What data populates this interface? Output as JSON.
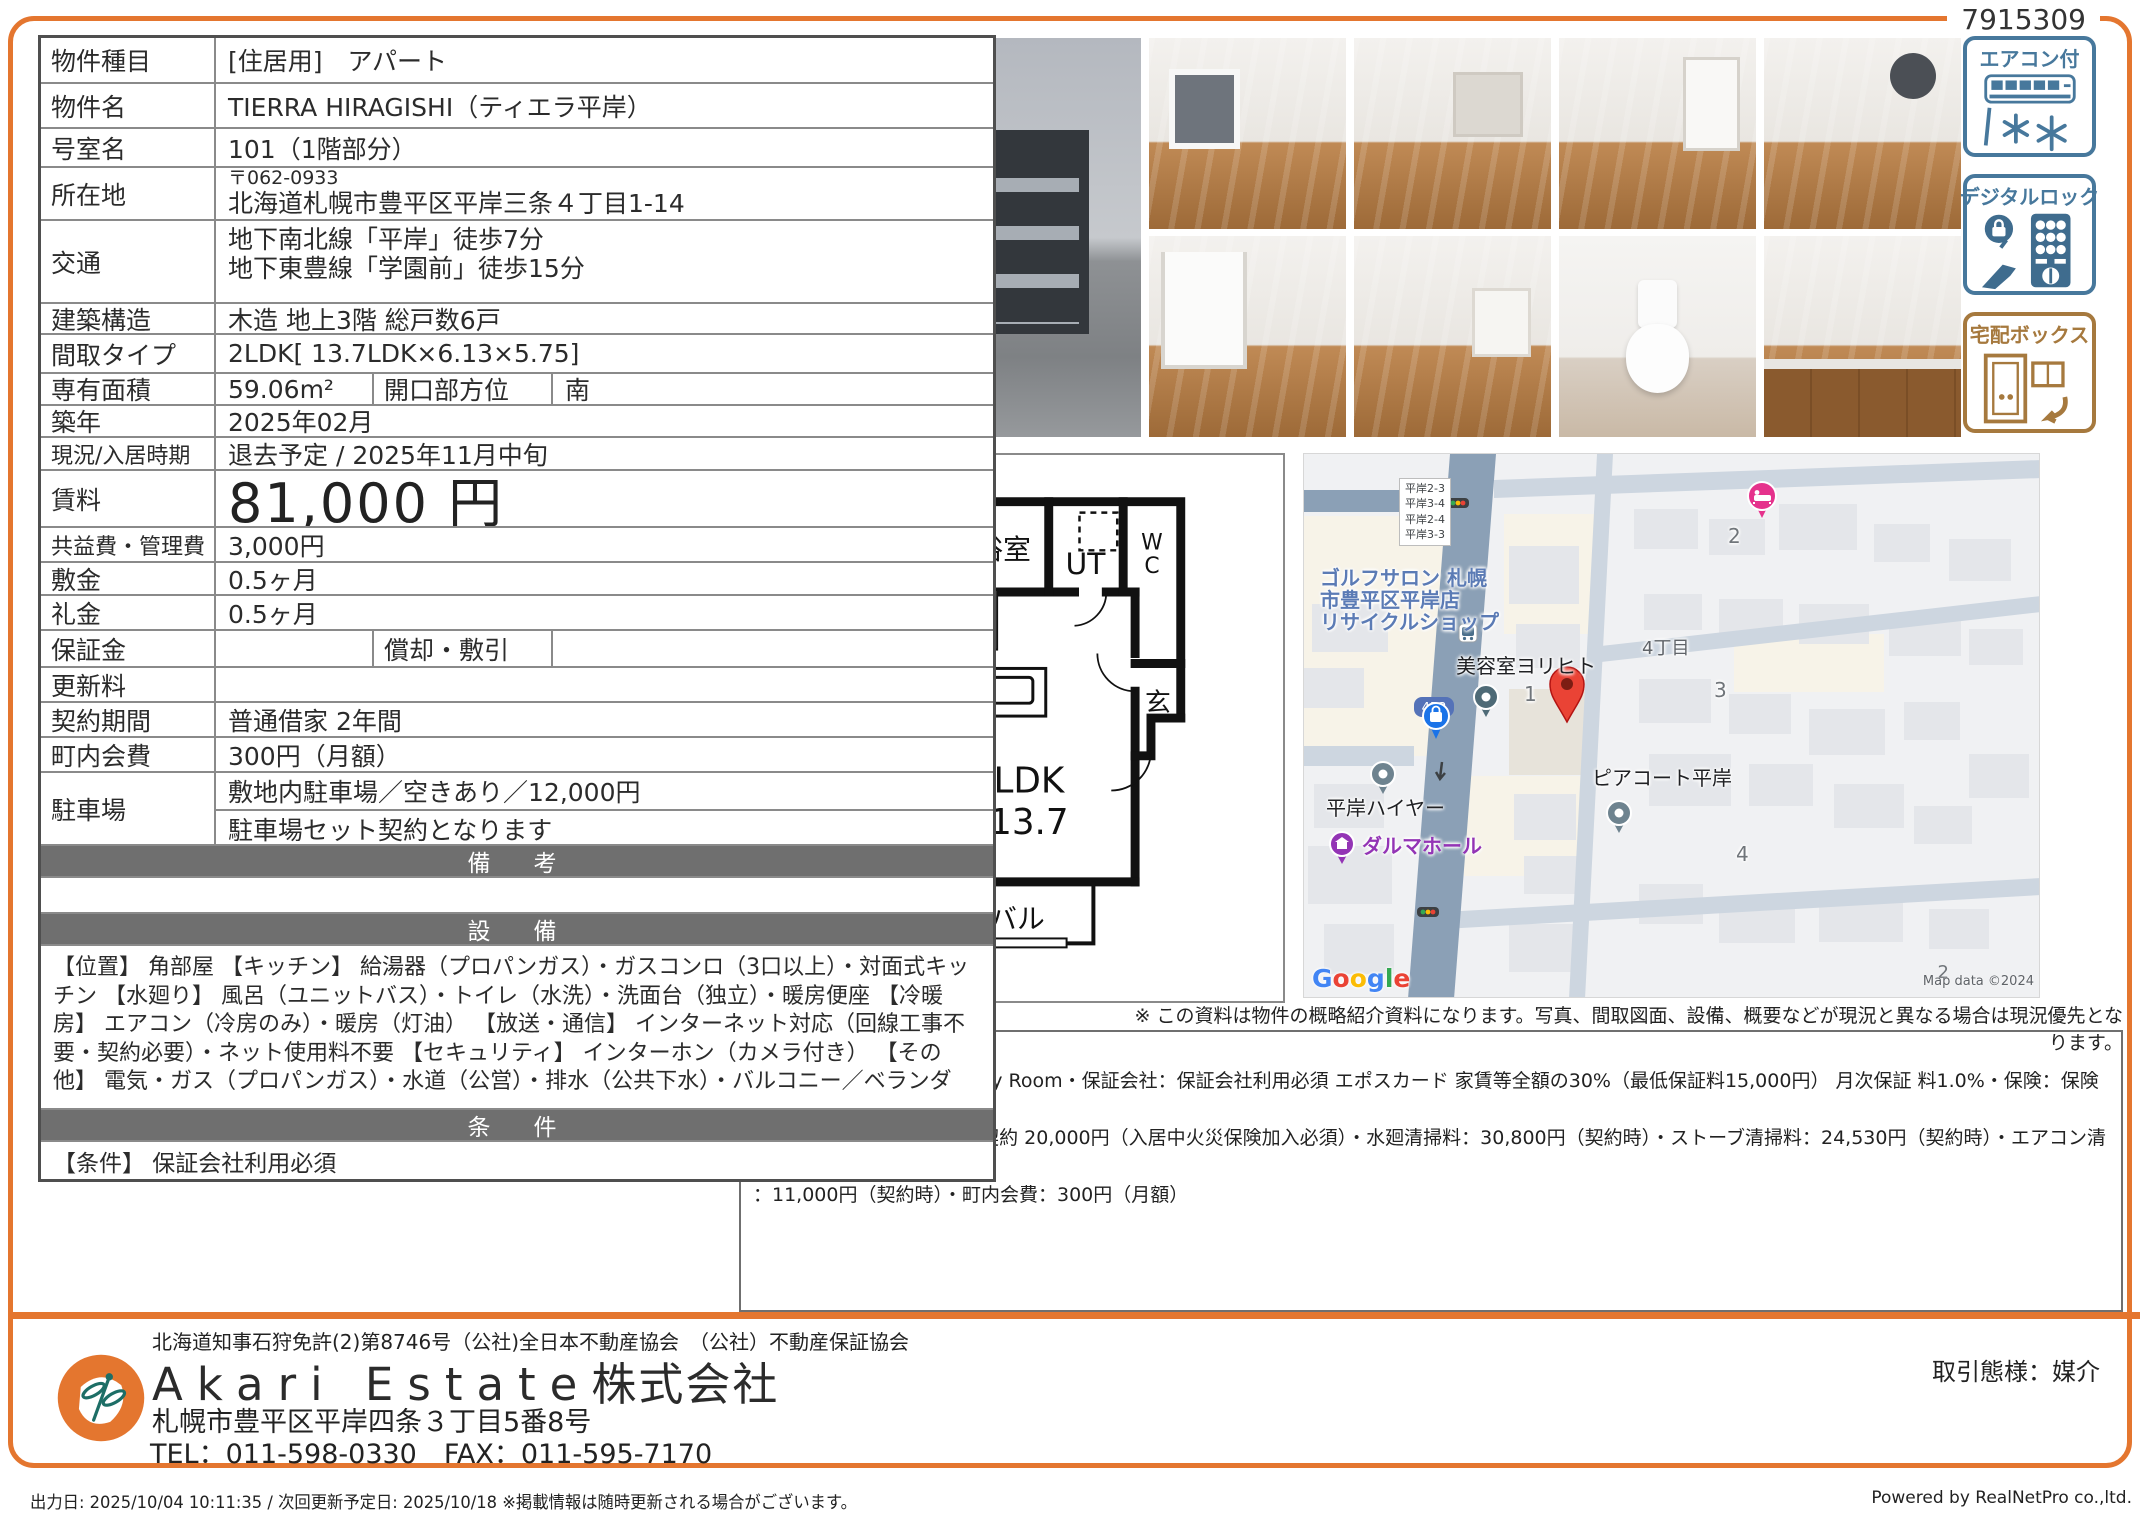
{
  "ref_number": "7915309",
  "colors": {
    "accent": "#e4762f",
    "header_bar": "#6f6f6f",
    "badge_blue": "#47789c",
    "badge_brown": "#a6793e"
  },
  "table": {
    "r1": {
      "label": "物件種目",
      "value": "[住居用]　アパート"
    },
    "r2": {
      "label": "物件名",
      "value": "TIERRA HIRAGISHI（ティエラ平岸）"
    },
    "r3": {
      "label": "号室名",
      "value": "101（1階部分）"
    },
    "r4": {
      "label": "所在地",
      "postal": "〒062-0933",
      "value": "北海道札幌市豊平区平岸三条４丁目1-14"
    },
    "r5": {
      "label": "交通",
      "line1": "地下南北線「平岸」徒歩7分",
      "line2": "地下東豊線「学園前」徒歩15分"
    },
    "r6": {
      "label": "建築構造",
      "value": "木造 地上3階 総戸数6戸"
    },
    "r7": {
      "label": "間取タイプ",
      "value": "2LDK[ 13.7LDK×6.13×5.75]"
    },
    "r8": {
      "label": "専有面積",
      "value": "59.06m²",
      "label2": "開口部方位",
      "value2": "南"
    },
    "r9": {
      "label": "築年",
      "value": "2025年02月"
    },
    "r10": {
      "label": "現況/入居時期",
      "value": "退去予定 / 2025年11月中旬"
    },
    "r11": {
      "label": "賃料",
      "value": "81,000 円"
    },
    "r12": {
      "label": "共益費・管理費",
      "value": "3,000円"
    },
    "r13": {
      "label": "敷金",
      "value": "0.5ヶ月"
    },
    "r14": {
      "label": "礼金",
      "value": "0.5ヶ月"
    },
    "r15": {
      "label": "保証金",
      "value": "",
      "label2": "償却・敷引",
      "value2": ""
    },
    "r16": {
      "label": "更新料",
      "value": ""
    },
    "r17": {
      "label": "契約期間",
      "value": "普通借家 2年間"
    },
    "r18": {
      "label": "町内会費",
      "value": "300円（月額）"
    },
    "r19": {
      "label": "駐車場",
      "line1": "敷地内駐車場／空きあり／12,000円",
      "line2": "駐車場セット契約となります"
    },
    "remarks_header": "備　考",
    "equipment_header": "設　備",
    "equipment_text": "【位置】 角部屋 【キッチン】 給湯器（プロパンガス）・ガスコンロ（3口以上）・対面式キッチン 【水廻り】 風呂（ユニットバス）・トイレ（水洗）・洗面台（独立）・暖房便座 【冷暖房】 エアコン（冷房のみ）・暖房（灯油） 【放送・通信】 インターネット対応（回線工事不要・契約必要）・ネット使用料不要 【セキュリティ】 インターホン（カメラ付き） 【その他】 電気・ガス（プロパンガス）・水道（公営）・排水（公共下水）・バルコニー／ベランダ",
    "conditions_header": "条　件",
    "conditions_text": "【条件】 保証会社利用必須"
  },
  "badges": {
    "aircon": "エアコン付",
    "digital_lock": "デジタルロック",
    "delivery_box": "宅配ボックス"
  },
  "floorplan": {
    "type": "Aタイプ",
    "bath": "浴室",
    "ut": "UT",
    "wc_w": "W",
    "wc_c": "C",
    "room1": "洋6.13",
    "closet": "クロ",
    "ldk": "LDK",
    "ldk_size": "13.7",
    "room2": "洋5.75",
    "balcony": "バル",
    "entrance": "玄"
  },
  "map": {
    "blocks": [
      "平岸2-3",
      "平岸3-4",
      "平岸2-4",
      "平岸3-3"
    ],
    "golf1": "ゴルフサロン 札幌",
    "golf2": "市豊平区平岸店",
    "golf3": "リサイクルショップ",
    "salon": "美容室ヨリヒト",
    "shield": "453",
    "district": "4丁目",
    "piacote": "ピアコート平岸",
    "taxi": "平岸ハイヤー",
    "daruma": "ダルマホール",
    "n1": "1",
    "n2": "2",
    "n3": "3",
    "n4": "4",
    "n5": "2",
    "google_letters": [
      "G",
      "o",
      "o",
      "g",
      "l",
      "e"
    ],
    "copyright": "Map data ©2024"
  },
  "disclaimer": "※ この資料は物件の概略紹介資料になります。写真、間取図面、設備、概要などが現況と異なる場合は現況優先となります。",
  "notes": {
    "title": "特記事項：",
    "line1": "インターネット：JcomIn My Room・保証会社：保証会社利用必須 エポスカード 家賃等全額の30%（最低保証料15,000円） 月次保証 料1.0%・保険：保険要加入",
    "line2": "　エポス少額短期保険 2年契約 20,000円（入居中火災保険加入必須）・水廻清掃料：30,800円（契約時）・ストーブ清掃料：24,530円（契約時）・エアコン清掃費",
    "line3": "：11,000円（契約時）・町内会費：300円（月額）"
  },
  "footer": {
    "license": "北海道知事石狩免許(2)第8746号（公社)全日本不動産協会　（公社）不動産保証協会",
    "company_en": "Akari Estate",
    "company_jp": "株式会社",
    "address": "札幌市豊平区平岸四条３丁目5番8号",
    "contact": "TEL：011-598-0330　FAX：011-595-7170",
    "transaction": "取引態様：媒介",
    "output_info": "出力日: 2025/10/04 10:11:35 / 次回更新予定日: 2025/10/18 ※掲載情報は随時更新される場合がございます。",
    "powered": "Powered by RealNetPro co.,ltd."
  }
}
